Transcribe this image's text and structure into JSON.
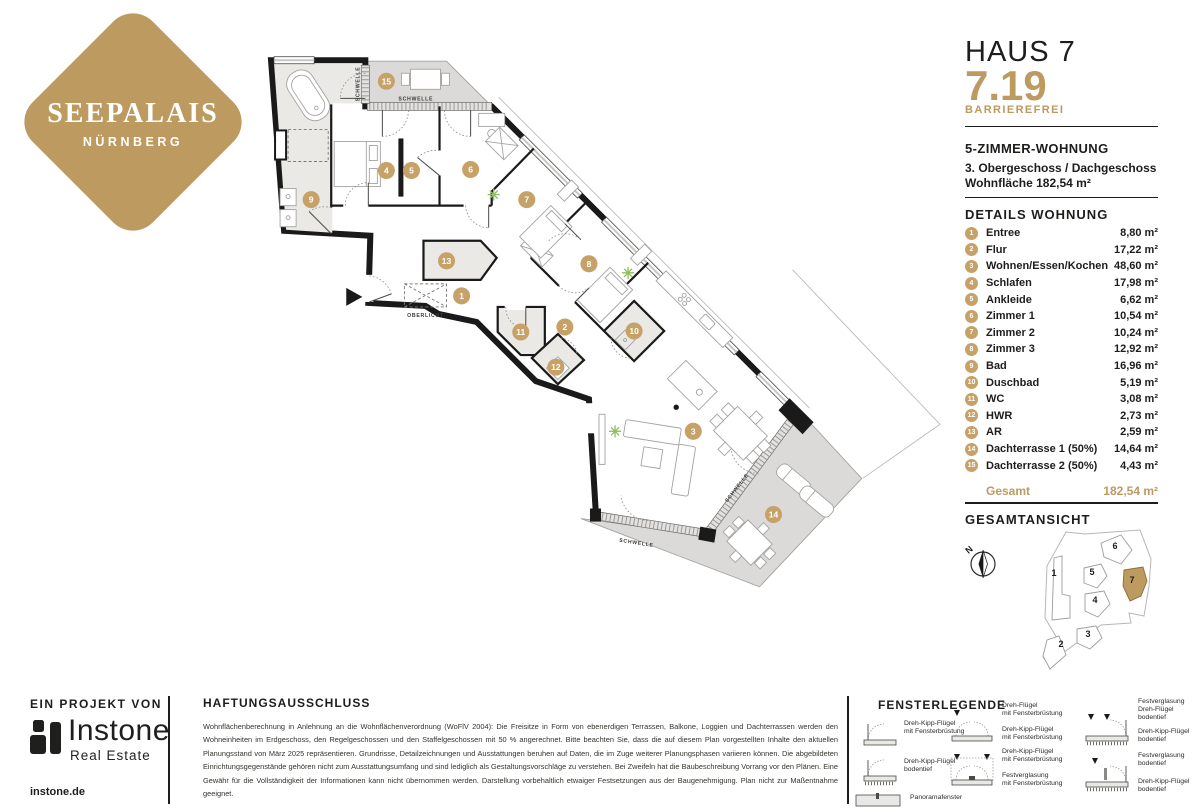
{
  "colors": {
    "gold": "#BD9A5F",
    "marker_gold": "#C6A268",
    "dark": "#1D1D1B",
    "wall": "#1A1A1A",
    "terrace": "#DBDAD8",
    "room_gray": "#EAE9E6"
  },
  "logo": {
    "title": "SEEPALAIS",
    "subtitle": "NÜRNBERG"
  },
  "header": {
    "house": "HAUS 7",
    "unit": "7.19",
    "badge": "BARRIEREFREI"
  },
  "summary": {
    "type": "5-ZIMMER-WOHNUNG",
    "floor": "3. Obergeschoss / Dachgeschoss",
    "area": "Wohnfläche 182,54 m²"
  },
  "details": {
    "heading": "DETAILS WOHNUNG",
    "rooms": [
      {
        "no": "1",
        "name": "Entree",
        "area": "8,80 m²"
      },
      {
        "no": "2",
        "name": "Flur",
        "area": "17,22 m²"
      },
      {
        "no": "3",
        "name": "Wohnen/Essen/Kochen",
        "area": "48,60 m²"
      },
      {
        "no": "4",
        "name": "Schlafen",
        "area": "17,98 m²"
      },
      {
        "no": "5",
        "name": "Ankleide",
        "area": "6,62 m²"
      },
      {
        "no": "6",
        "name": "Zimmer 1",
        "area": "10,54 m²"
      },
      {
        "no": "7",
        "name": "Zimmer 2",
        "area": "10,24 m²"
      },
      {
        "no": "8",
        "name": "Zimmer 3",
        "area": "12,92 m²"
      },
      {
        "no": "9",
        "name": "Bad",
        "area": "16,96 m²"
      },
      {
        "no": "10",
        "name": "Duschbad",
        "area": "5,19 m²"
      },
      {
        "no": "11",
        "name": "WC",
        "area": "3,08 m²"
      },
      {
        "no": "12",
        "name": "HWR",
        "area": "2,73 m²"
      },
      {
        "no": "13",
        "name": "AR",
        "area": "2,59 m²"
      },
      {
        "no": "14",
        "name": "Dachterrasse 1 (50%)",
        "area": "14,64 m²"
      },
      {
        "no": "15",
        "name": "Dachterrasse 2 (50%)",
        "area": "4,43 m²"
      }
    ],
    "total_label": "Gesamt",
    "total_value": "182,54 m²"
  },
  "plan": {
    "schwelle": "SCHWELLE",
    "oberlicht": "OBERLICHT",
    "markers": [
      {
        "no": "1",
        "x": 203,
        "y": 242
      },
      {
        "no": "2",
        "x": 306,
        "y": 273
      },
      {
        "no": "3",
        "x": 434,
        "y": 377
      },
      {
        "no": "4",
        "x": 128,
        "y": 117
      },
      {
        "no": "5",
        "x": 153,
        "y": 117
      },
      {
        "no": "6",
        "x": 212,
        "y": 116
      },
      {
        "no": "7",
        "x": 268,
        "y": 146
      },
      {
        "no": "8",
        "x": 330,
        "y": 210
      },
      {
        "no": "9",
        "x": 53,
        "y": 146
      },
      {
        "no": "10",
        "x": 375,
        "y": 277
      },
      {
        "no": "11",
        "x": 262,
        "y": 278
      },
      {
        "no": "12",
        "x": 297,
        "y": 313
      },
      {
        "no": "13",
        "x": 188,
        "y": 207
      },
      {
        "no": "14",
        "x": 514,
        "y": 460
      },
      {
        "no": "15",
        "x": 128,
        "y": 28
      }
    ]
  },
  "overview": {
    "heading": "GESAMTANSICHT",
    "compass": "N",
    "highlighted": "7",
    "buildings": [
      {
        "no": "1",
        "x": 106,
        "y": 50
      },
      {
        "no": "2",
        "x": 113,
        "y": 121
      },
      {
        "no": "3",
        "x": 140,
        "y": 111
      },
      {
        "no": "4",
        "x": 147,
        "y": 77
      },
      {
        "no": "5",
        "x": 144,
        "y": 49
      },
      {
        "no": "6",
        "x": 167,
        "y": 23
      },
      {
        "no": "7",
        "x": 184,
        "y": 57
      }
    ]
  },
  "footer": {
    "project_label": "EIN PROJEKT VON",
    "brand_name": "Instone",
    "brand_sub": "Real Estate",
    "brand_url": "instone.de",
    "disclaimer_heading": "HAFTUNGSAUSSCHLUSS",
    "disclaimer_text": "Wohnflächenberechnung in Anlehnung an die Wohnflächenverordnung (WoFlV 2004): Die Freisitze in Form von ebenerdigen Terrassen, Balkone, Loggien und Dachterrassen werden den Wohneinheiten im Erdgeschoss, den Regelgeschossen und den Staffelgeschossen mit 50 % angerechnet. Bitte beachten Sie, dass die auf diesem Plan vorgestellten Inhalte den aktuellen Planungsstand von März 2025 repräsentieren. Grundrisse, Detailzeichnungen und Ausstattungen beruhen auf Daten, die im Zuge weiterer Planungsphasen variieren können. Die abgebildeten Einrichtungsgegenstände gehören nicht zum Ausstattungsumfang und sind lediglich als Gestaltungsvorschläge zu verstehen. Bei Zweifeln hat die Baubeschreibung Vorrang vor den Plänen. Eine Gewähr für die Vollständigkeit der Informationen kann nicht übernommen werden. Darstellung vorbehaltlich etwaiger Festsetzungen aus der Baugenehmigung. Plan nicht zur Maßentnahme geeignet.",
    "legend": {
      "heading": "FENSTERLEGENDE",
      "col1": [
        {
          "label": "Dreh-Kipp-Flügel\nmit Fensterbrüstung"
        },
        {
          "label": "Dreh-Kipp-Flügel\nbodentief"
        },
        {
          "label": "Panoramafenster"
        }
      ],
      "col2": [
        {
          "label_a": "Dreh-Flügel\nmit Fensterbrüstung",
          "label_b": "Dreh-Kipp-Flügel\nmit Fensterbrüstung"
        },
        {
          "label_a": "Dreh-Kipp-Flügel\nmit Fensterbrüstung",
          "label_b": "Festverglasung\nmit Fensterbrüstung"
        }
      ],
      "col3": [
        {
          "label_a": "Festverglasung\nDreh-Flügel bodentief",
          "label_b": "Dreh-Kipp-Flügel\nbodentief"
        },
        {
          "label_a": "Festverglasung\nbodentief",
          "label_b": "Dreh-Kipp-Flügel\nbodentief"
        }
      ]
    }
  }
}
